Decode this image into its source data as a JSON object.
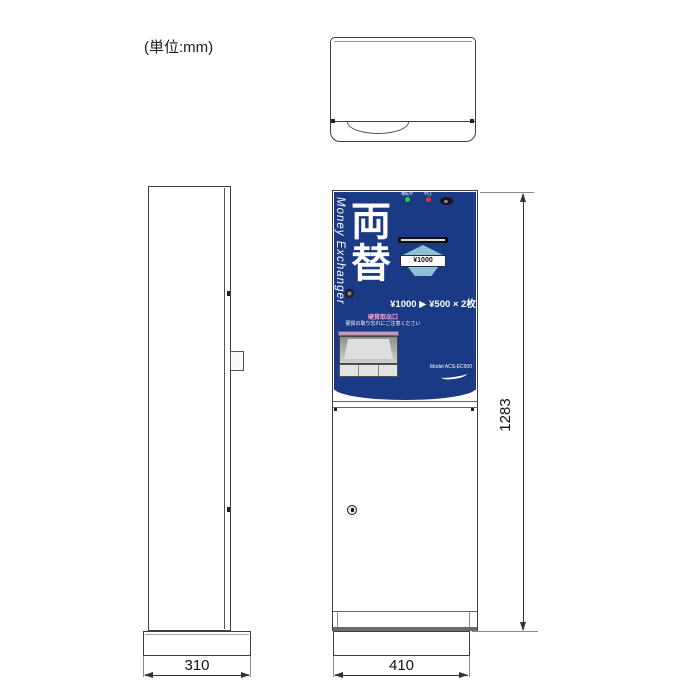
{
  "unit_label": "(単位:mm)",
  "dimensions": {
    "side_width": "310",
    "front_width": "410",
    "height": "1283"
  },
  "front_panel": {
    "brand_vertical": "Money Exchanger",
    "title": "両替",
    "indicators": [
      {
        "label": "運転中",
        "color": "#2ecc40"
      },
      {
        "label": "中止",
        "color": "#e63030"
      }
    ],
    "bill_label": "¥1000",
    "rate_text": "¥1000 ▶ ¥500 × 2枚",
    "coin_outlet_title": "硬貨取出口",
    "coin_outlet_note": "硬貨の取り忘れにご注意ください",
    "model_text": "Model ACS-EC500"
  },
  "colors": {
    "panel_blue": "#1b3a86",
    "light_blue": "#8fc0d8",
    "green_led": "#2ecc40",
    "red_led": "#e63030",
    "tray_pink": "#c49ab0",
    "coin_title_pink": "#f2a9c9",
    "line_gray": "#3f3f3f"
  }
}
